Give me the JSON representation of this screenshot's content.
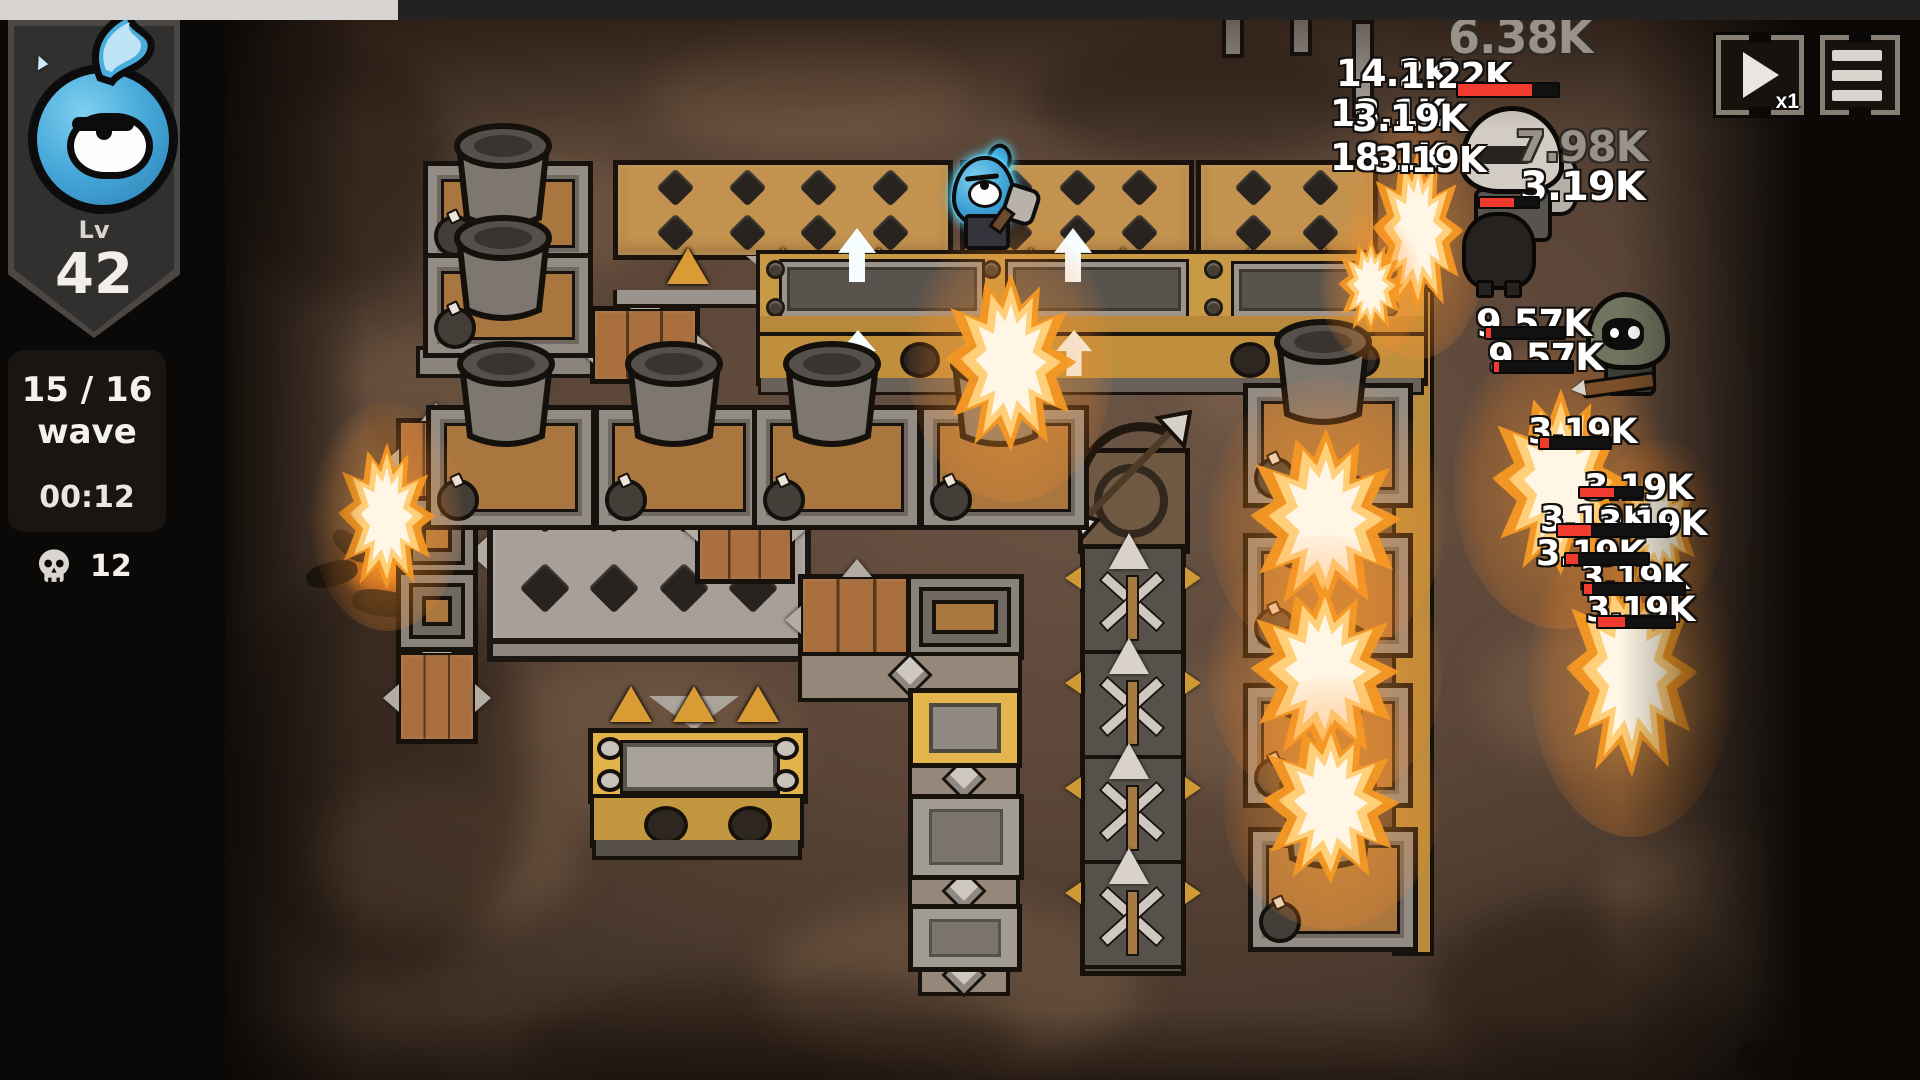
{
  "hud": {
    "level_label": "Lv",
    "level_value": "42",
    "wave_line1": "15 / 16",
    "wave_line2": "wave",
    "timer": "00:12",
    "kill_count": "12",
    "speed_label": "x1"
  },
  "colors": {
    "field_brown": "#5a4537",
    "panel_black": "#0b0908",
    "accent_gold": "#e2b34b",
    "wall_tan": "#c2924e",
    "hp_red": "#f03b2e",
    "glow_cyan": "#4fd4ff",
    "flame_orange": "#f59824"
  },
  "combat": {
    "damage_numbers": [
      {
        "t": "6.38K",
        "x": 1448,
        "y": 10,
        "s": 46,
        "v": "g"
      },
      {
        "t": "14.2K",
        "x": 1336,
        "y": 52,
        "s": 37,
        "v": "w"
      },
      {
        "t": "1.22K",
        "x": 1400,
        "y": 56,
        "s": 36,
        "v": "w"
      },
      {
        "t": "13.1K",
        "x": 1330,
        "y": 92,
        "s": 37,
        "v": "w"
      },
      {
        "t": "3.19K",
        "x": 1352,
        "y": 97,
        "s": 37,
        "v": "w"
      },
      {
        "t": "18.1K",
        "x": 1330,
        "y": 136,
        "s": 37,
        "v": "w"
      },
      {
        "t": "3.19K",
        "x": 1374,
        "y": 140,
        "s": 36,
        "v": "w"
      },
      {
        "t": "7.98K",
        "x": 1516,
        "y": 122,
        "s": 42,
        "v": "g"
      },
      {
        "t": "3.19K",
        "x": 1520,
        "y": 164,
        "s": 40,
        "v": "w"
      },
      {
        "t": "9.57K",
        "x": 1476,
        "y": 302,
        "s": 37,
        "v": "w"
      },
      {
        "t": "9.57K",
        "x": 1488,
        "y": 336,
        "s": 37,
        "v": "w"
      },
      {
        "t": "3.19K",
        "x": 1528,
        "y": 412,
        "s": 35,
        "v": "w"
      },
      {
        "t": "3.19K",
        "x": 1584,
        "y": 468,
        "s": 35,
        "v": "w"
      },
      {
        "t": "3.19K",
        "x": 1540,
        "y": 500,
        "s": 35,
        "v": "w"
      },
      {
        "t": "3.19K",
        "x": 1598,
        "y": 504,
        "s": 35,
        "v": "w"
      },
      {
        "t": "3.19K",
        "x": 1536,
        "y": 534,
        "s": 35,
        "v": "w"
      },
      {
        "t": "3.19K",
        "x": 1580,
        "y": 558,
        "s": 35,
        "v": "w"
      },
      {
        "t": "3.19K",
        "x": 1586,
        "y": 590,
        "s": 35,
        "v": "w"
      }
    ],
    "health_bars": [
      {
        "x": 1456,
        "y": 82,
        "w": 100,
        "h": 12,
        "p": 0.74
      },
      {
        "x": 1478,
        "y": 196,
        "w": 58,
        "h": 9,
        "p": 0.58
      },
      {
        "x": 1484,
        "y": 326,
        "w": 78,
        "h": 10,
        "p": 0.07
      },
      {
        "x": 1492,
        "y": 360,
        "w": 78,
        "h": 10,
        "p": 0.07
      },
      {
        "x": 1538,
        "y": 436,
        "w": 70,
        "h": 10,
        "p": 0.13
      },
      {
        "x": 1578,
        "y": 486,
        "w": 62,
        "h": 9,
        "p": 0.55
      },
      {
        "x": 1556,
        "y": 523,
        "w": 110,
        "h": 11,
        "p": 0.3
      },
      {
        "x": 1564,
        "y": 552,
        "w": 82,
        "h": 10,
        "p": 0.15
      },
      {
        "x": 1582,
        "y": 582,
        "w": 100,
        "h": 10,
        "p": 0.08
      },
      {
        "x": 1596,
        "y": 615,
        "w": 76,
        "h": 10,
        "p": 0.36
      }
    ]
  },
  "scene": {
    "structures": [
      {
        "t": "plight",
        "x": 430,
        "y": 150,
        "w": 230,
        "h": 130
      },
      {
        "t": "plight",
        "x": 480,
        "y": 660,
        "w": 320,
        "h": 170
      },
      {
        "t": "plight",
        "x": 300,
        "y": 780,
        "w": 280,
        "h": 150
      },
      {
        "t": "plight",
        "x": 760,
        "y": 900,
        "w": 380,
        "h": 170
      },
      {
        "t": "plight",
        "x": 1140,
        "y": 660,
        "w": 220,
        "h": 130
      },
      {
        "t": "plight",
        "x": 1480,
        "y": 620,
        "w": 240,
        "h": 150
      },
      {
        "t": "plight",
        "x": 1600,
        "y": 830,
        "w": 280,
        "h": 170
      },
      {
        "t": "plight",
        "x": 650,
        "y": 40,
        "w": 320,
        "h": 110
      },
      {
        "t": "plight",
        "x": 1180,
        "y": 330,
        "w": 160,
        "h": 110
      },
      {
        "t": "plight",
        "x": 340,
        "y": 330,
        "w": 160,
        "h": 100
      },
      {
        "t": "pdark",
        "x": 230,
        "y": 560,
        "w": 300,
        "h": 420
      },
      {
        "t": "pdark",
        "x": 230,
        "y": 40,
        "w": 220,
        "h": 260
      },
      {
        "t": "pdark",
        "x": 1030,
        "y": 40,
        "w": 340,
        "h": 120
      },
      {
        "t": "pdark",
        "x": 520,
        "y": 980,
        "w": 500,
        "h": 120
      },
      {
        "t": "pdark",
        "x": 1430,
        "y": 900,
        "w": 300,
        "h": 180
      },
      {
        "t": "mortar-short",
        "x": 423,
        "y": 116
      },
      {
        "t": "mortar-short",
        "x": 423,
        "y": 208
      },
      {
        "t": "mortar-tall",
        "x": 426,
        "y": 330
      },
      {
        "t": "mortar-tall",
        "x": 594,
        "y": 330
      },
      {
        "t": "mortar-tall",
        "x": 752,
        "y": 330
      },
      {
        "t": "mortar-tall",
        "x": 919,
        "y": 330
      },
      {
        "t": "mortar-tall",
        "x": 1243,
        "y": 308
      },
      {
        "t": "mortar-tall",
        "x": 1243,
        "y": 458
      },
      {
        "t": "mortar-tall",
        "x": 1243,
        "y": 608
      },
      {
        "t": "mortar-tall",
        "x": 1248,
        "y": 752
      },
      {
        "t": "crate",
        "x": 590,
        "y": 306,
        "w": 100,
        "h": 68
      },
      {
        "t": "crate",
        "x": 695,
        "y": 474,
        "w": 90,
        "h": 100
      },
      {
        "t": "crate",
        "x": 798,
        "y": 574,
        "w": 108,
        "h": 76
      },
      {
        "t": "crate",
        "x": 396,
        "y": 418,
        "w": 70,
        "h": 74
      },
      {
        "t": "crate",
        "x": 396,
        "y": 650,
        "w": 72,
        "h": 84
      },
      {
        "t": "nested",
        "x": 906,
        "y": 574,
        "w": 108,
        "h": 76
      },
      {
        "t": "nested",
        "x": 396,
        "y": 496,
        "w": 72,
        "h": 72
      },
      {
        "t": "nested",
        "x": 396,
        "y": 570,
        "w": 72,
        "h": 72
      },
      {
        "t": "chev",
        "x": 798,
        "y": 652,
        "w": 216,
        "h": 42
      },
      {
        "t": "chev",
        "x": 908,
        "y": 760,
        "w": 104,
        "h": 34
      },
      {
        "t": "chev",
        "x": 908,
        "y": 872,
        "w": 104,
        "h": 34
      },
      {
        "t": "chev",
        "x": 918,
        "y": 958,
        "w": 84,
        "h": 30
      },
      {
        "t": "ypanel",
        "x": 908,
        "y": 688,
        "w": 104,
        "h": 70
      },
      {
        "t": "gpanel",
        "x": 908,
        "y": 794,
        "w": 106,
        "h": 76
      },
      {
        "t": "gpanel",
        "x": 908,
        "y": 904,
        "w": 104,
        "h": 58
      },
      {
        "t": "post",
        "x": 1222,
        "y": 12,
        "h": 38
      },
      {
        "t": "post",
        "x": 1290,
        "y": 6,
        "h": 42
      },
      {
        "t": "post",
        "x": 1352,
        "y": 20,
        "h": 90
      },
      {
        "t": "gmark",
        "x": 1792,
        "y": 424
      },
      {
        "t": "gmark",
        "x": 1786,
        "y": 502
      },
      {
        "t": "flame",
        "x": 945,
        "y": 272,
        "w": 132,
        "h": 180
      },
      {
        "t": "flame",
        "x": 1372,
        "y": 148,
        "w": 92,
        "h": 165
      },
      {
        "t": "flame",
        "x": 1338,
        "y": 238,
        "w": 66,
        "h": 95
      },
      {
        "t": "flame",
        "x": 1250,
        "y": 428,
        "w": 152,
        "h": 182
      },
      {
        "t": "flame",
        "x": 1250,
        "y": 584,
        "w": 150,
        "h": 175
      },
      {
        "t": "flame",
        "x": 1262,
        "y": 722,
        "w": 138,
        "h": 162
      },
      {
        "t": "flame",
        "x": 1492,
        "y": 388,
        "w": 138,
        "h": 188
      },
      {
        "t": "flame",
        "x": 1566,
        "y": 566,
        "w": 132,
        "h": 212
      },
      {
        "t": "flame",
        "x": 1618,
        "y": 470,
        "w": 82,
        "h": 112
      },
      {
        "t": "flame",
        "x": 338,
        "y": 442,
        "w": 98,
        "h": 148
      }
    ]
  }
}
